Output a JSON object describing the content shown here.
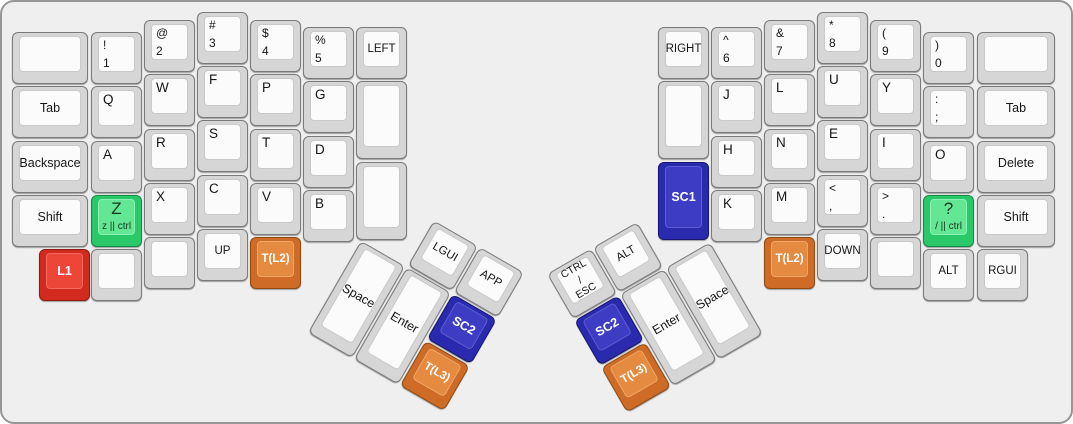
{
  "board": {
    "name": "split-keyboard-layout",
    "background": "#efefef",
    "case_border": "#969696"
  },
  "colors": {
    "default": {
      "side": "#d6d6d6",
      "top": "#fbfbfb",
      "border": "#7a7a7a",
      "topBorder": "#c9c9c9",
      "text": "#161616"
    },
    "red": {
      "side": "#d22a1e",
      "top": "#ee4539",
      "border": "#8f1a12",
      "topBorder": "#f26a60",
      "text": "#ffffff"
    },
    "green": {
      "side": "#29c96a",
      "top": "#63e794",
      "border": "#128a43",
      "topBorder": "#8df0b4",
      "text": "#12351f"
    },
    "blue": {
      "side": "#2a2aae",
      "top": "#3d3dc4",
      "border": "#16166e",
      "topBorder": "#5c5cd4",
      "text": "#ffffff"
    },
    "orange": {
      "side": "#cd6b27",
      "top": "#e58a41",
      "border": "#8f4a12",
      "topBorder": "#efa768",
      "text": "#ffffff"
    }
  },
  "clusters": [
    {
      "name": "left-thumb-cluster",
      "x": 386,
      "y": 192,
      "angle": 30
    },
    {
      "name": "right-thumb-cluster",
      "x": 545,
      "y": 272,
      "angle": -30
    }
  ],
  "keys": [
    {
      "name": "key-blank-left-top",
      "x": 10,
      "y": 30,
      "w": 76
    },
    {
      "name": "key-tab-left",
      "x": 10,
      "y": 84,
      "w": 76,
      "label": {
        "style": "center",
        "lines": [
          "Tab"
        ]
      }
    },
    {
      "name": "key-backspace",
      "x": 10,
      "y": 139,
      "w": 76,
      "label": {
        "style": "center",
        "lines": [
          "Backspace"
        ]
      }
    },
    {
      "name": "key-shift-left",
      "x": 10,
      "y": 193,
      "w": 76,
      "label": {
        "style": "center",
        "lines": [
          "Shift"
        ]
      }
    },
    {
      "name": "key-l1",
      "x": 37,
      "y": 247,
      "color": "red",
      "label": {
        "style": "center",
        "bold": true,
        "lines": [
          "L1"
        ]
      }
    },
    {
      "name": "key-exclam-1",
      "x": 89,
      "y": 30,
      "label": {
        "style": "sym",
        "lines": [
          "!",
          "1"
        ]
      }
    },
    {
      "name": "key-q",
      "x": 89,
      "y": 84,
      "label": {
        "style": "letter",
        "lines": [
          "Q"
        ]
      }
    },
    {
      "name": "key-a",
      "x": 89,
      "y": 139,
      "label": {
        "style": "letter",
        "lines": [
          "A"
        ]
      }
    },
    {
      "name": "key-z-ctrl",
      "x": 89,
      "y": 193,
      "color": "green",
      "label": {
        "style": "combo",
        "lines": [
          "Z",
          "z || ctrl"
        ]
      }
    },
    {
      "name": "key-blank-left-col2-bottom",
      "x": 89,
      "y": 247
    },
    {
      "name": "key-at-2",
      "x": 142,
      "y": 18,
      "label": {
        "style": "sym",
        "lines": [
          "@",
          "2"
        ]
      }
    },
    {
      "name": "key-w",
      "x": 142,
      "y": 72,
      "label": {
        "style": "letter",
        "lines": [
          "W"
        ]
      }
    },
    {
      "name": "key-r",
      "x": 142,
      "y": 127,
      "label": {
        "style": "letter",
        "lines": [
          "R"
        ]
      }
    },
    {
      "name": "key-x",
      "x": 142,
      "y": 181,
      "label": {
        "style": "letter",
        "lines": [
          "X"
        ]
      }
    },
    {
      "name": "key-blank-left-col3-bottom",
      "x": 142,
      "y": 235
    },
    {
      "name": "key-hash-3",
      "x": 195,
      "y": 10,
      "label": {
        "style": "sym",
        "lines": [
          "#",
          "3"
        ]
      }
    },
    {
      "name": "key-f",
      "x": 195,
      "y": 64,
      "label": {
        "style": "letter",
        "lines": [
          "F"
        ]
      }
    },
    {
      "name": "key-s",
      "x": 195,
      "y": 118,
      "label": {
        "style": "letter",
        "lines": [
          "S"
        ]
      }
    },
    {
      "name": "key-c",
      "x": 195,
      "y": 173,
      "label": {
        "style": "letter",
        "lines": [
          "C"
        ]
      }
    },
    {
      "name": "key-up",
      "x": 195,
      "y": 227,
      "label": {
        "style": "center-small",
        "lines": [
          "UP"
        ]
      }
    },
    {
      "name": "key-dollar-4",
      "x": 248,
      "y": 18,
      "label": {
        "style": "sym",
        "lines": [
          "$",
          "4"
        ]
      }
    },
    {
      "name": "key-p",
      "x": 248,
      "y": 72,
      "label": {
        "style": "letter",
        "lines": [
          "P"
        ]
      }
    },
    {
      "name": "key-t",
      "x": 248,
      "y": 127,
      "label": {
        "style": "letter",
        "lines": [
          "T"
        ]
      }
    },
    {
      "name": "key-v",
      "x": 248,
      "y": 181,
      "label": {
        "style": "letter",
        "lines": [
          "V"
        ]
      }
    },
    {
      "name": "key-t-l2-left",
      "x": 248,
      "y": 235,
      "color": "orange",
      "label": {
        "style": "center-small",
        "bold": true,
        "lines": [
          "T(L2)"
        ]
      }
    },
    {
      "name": "key-percent-5",
      "x": 301,
      "y": 25,
      "label": {
        "style": "sym",
        "lines": [
          "%",
          "5"
        ]
      }
    },
    {
      "name": "key-g",
      "x": 301,
      "y": 79,
      "label": {
        "style": "letter",
        "lines": [
          "G"
        ]
      }
    },
    {
      "name": "key-d",
      "x": 301,
      "y": 134,
      "label": {
        "style": "letter",
        "lines": [
          "D"
        ]
      }
    },
    {
      "name": "key-b",
      "x": 301,
      "y": 188,
      "label": {
        "style": "letter",
        "lines": [
          "B"
        ]
      }
    },
    {
      "name": "key-left",
      "x": 354,
      "y": 25,
      "label": {
        "style": "center-small",
        "lines": [
          "LEFT"
        ]
      }
    },
    {
      "name": "key-blank-left-col7-mid",
      "x": 354,
      "y": 79,
      "h": 78
    },
    {
      "name": "key-blank-left-col7-bottom",
      "x": 354,
      "y": 160,
      "h": 78
    },
    {
      "name": "key-space-left",
      "cluster": "left-thumb-cluster",
      "x": 0,
      "y": 54,
      "h": 106,
      "label": {
        "style": "center",
        "lines": [
          "Space"
        ]
      }
    },
    {
      "name": "key-enter-left",
      "cluster": "left-thumb-cluster",
      "x": 53,
      "y": 54,
      "h": 106,
      "label": {
        "style": "center",
        "lines": [
          "Enter"
        ]
      }
    },
    {
      "name": "key-lgui",
      "cluster": "left-thumb-cluster",
      "x": 53,
      "y": 0,
      "label": {
        "style": "center-small",
        "lines": [
          "LGUI"
        ]
      }
    },
    {
      "name": "key-app",
      "cluster": "left-thumb-cluster",
      "x": 106,
      "y": 0,
      "label": {
        "style": "center-small",
        "lines": [
          "APP"
        ]
      }
    },
    {
      "name": "key-sc2-left",
      "cluster": "left-thumb-cluster",
      "x": 106,
      "y": 54,
      "color": "blue",
      "label": {
        "style": "center",
        "bold": true,
        "lines": [
          "SC2"
        ]
      }
    },
    {
      "name": "key-t-l3-left",
      "cluster": "left-thumb-cluster",
      "x": 106,
      "y": 108,
      "color": "orange",
      "label": {
        "style": "center-small",
        "bold": true,
        "lines": [
          "T(L3)"
        ]
      }
    },
    {
      "name": "key-right",
      "x": 656,
      "y": 25,
      "label": {
        "style": "center-small",
        "lines": [
          "RIGHT"
        ]
      }
    },
    {
      "name": "key-blank-right-col1-mid",
      "x": 656,
      "y": 79,
      "h": 78
    },
    {
      "name": "key-sc1",
      "x": 656,
      "y": 160,
      "h": 78,
      "color": "blue",
      "label": {
        "style": "center",
        "bold": true,
        "lines": [
          "SC1"
        ]
      }
    },
    {
      "name": "key-caret-6",
      "x": 709,
      "y": 25,
      "label": {
        "style": "sym",
        "lines": [
          "^",
          "6"
        ]
      }
    },
    {
      "name": "key-j",
      "x": 709,
      "y": 79,
      "label": {
        "style": "letter",
        "lines": [
          "J"
        ]
      }
    },
    {
      "name": "key-h",
      "x": 709,
      "y": 134,
      "label": {
        "style": "letter",
        "lines": [
          "H"
        ]
      }
    },
    {
      "name": "key-k",
      "x": 709,
      "y": 188,
      "label": {
        "style": "letter",
        "lines": [
          "K"
        ]
      }
    },
    {
      "name": "key-amp-7",
      "x": 762,
      "y": 18,
      "label": {
        "style": "sym",
        "lines": [
          "&",
          "7"
        ]
      }
    },
    {
      "name": "key-l",
      "x": 762,
      "y": 72,
      "label": {
        "style": "letter",
        "lines": [
          "L"
        ]
      }
    },
    {
      "name": "key-n",
      "x": 762,
      "y": 127,
      "label": {
        "style": "letter",
        "lines": [
          "N"
        ]
      }
    },
    {
      "name": "key-m",
      "x": 762,
      "y": 181,
      "label": {
        "style": "letter",
        "lines": [
          "M"
        ]
      }
    },
    {
      "name": "key-t-l2-right",
      "x": 762,
      "y": 235,
      "color": "orange",
      "label": {
        "style": "center-small",
        "bold": true,
        "lines": [
          "T(L2)"
        ]
      }
    },
    {
      "name": "key-star-8",
      "x": 815,
      "y": 10,
      "label": {
        "style": "sym",
        "lines": [
          "*",
          "8"
        ]
      }
    },
    {
      "name": "key-u",
      "x": 815,
      "y": 64,
      "label": {
        "style": "letter",
        "lines": [
          "U"
        ]
      }
    },
    {
      "name": "key-e",
      "x": 815,
      "y": 118,
      "label": {
        "style": "letter",
        "lines": [
          "E"
        ]
      }
    },
    {
      "name": "key-less-comma",
      "x": 815,
      "y": 173,
      "label": {
        "style": "sym",
        "lines": [
          "<",
          ","
        ]
      }
    },
    {
      "name": "key-down",
      "x": 815,
      "y": 227,
      "label": {
        "style": "center-small",
        "lines": [
          "DOWN"
        ]
      }
    },
    {
      "name": "key-paren-9",
      "x": 868,
      "y": 18,
      "label": {
        "style": "sym",
        "lines": [
          "(",
          "9"
        ]
      }
    },
    {
      "name": "key-y",
      "x": 868,
      "y": 72,
      "label": {
        "style": "letter",
        "lines": [
          "Y"
        ]
      }
    },
    {
      "name": "key-i",
      "x": 868,
      "y": 127,
      "label": {
        "style": "letter",
        "lines": [
          "I"
        ]
      }
    },
    {
      "name": "key-greater-period",
      "x": 868,
      "y": 181,
      "label": {
        "style": "sym",
        "lines": [
          ">",
          "."
        ]
      }
    },
    {
      "name": "key-blank-right-col5-bottom",
      "x": 868,
      "y": 235
    },
    {
      "name": "key-paren-0",
      "x": 921,
      "y": 30,
      "label": {
        "style": "sym",
        "lines": [
          ")",
          "0"
        ]
      }
    },
    {
      "name": "key-colon-semicolon",
      "x": 921,
      "y": 84,
      "label": {
        "style": "sym",
        "lines": [
          ":",
          ";"
        ]
      }
    },
    {
      "name": "key-o",
      "x": 921,
      "y": 139,
      "label": {
        "style": "letter",
        "lines": [
          "O"
        ]
      }
    },
    {
      "name": "key-question-ctrl",
      "x": 921,
      "y": 193,
      "color": "green",
      "label": {
        "style": "combo",
        "lines": [
          "?",
          "/ || ctrl"
        ]
      }
    },
    {
      "name": "key-alt",
      "x": 921,
      "y": 247,
      "label": {
        "style": "center-small",
        "lines": [
          "ALT"
        ]
      }
    },
    {
      "name": "key-blank-right-top",
      "x": 975,
      "y": 30,
      "w": 78
    },
    {
      "name": "key-tab-right",
      "x": 975,
      "y": 84,
      "w": 78,
      "label": {
        "style": "center",
        "lines": [
          "Tab"
        ]
      }
    },
    {
      "name": "key-delete",
      "x": 975,
      "y": 139,
      "w": 78,
      "label": {
        "style": "center",
        "lines": [
          "Delete"
        ]
      }
    },
    {
      "name": "key-shift-right",
      "x": 975,
      "y": 193,
      "w": 78,
      "label": {
        "style": "center",
        "lines": [
          "Shift"
        ]
      }
    },
    {
      "name": "key-rgui",
      "x": 975,
      "y": 247,
      "label": {
        "style": "center-small",
        "lines": [
          "RGUI"
        ]
      }
    },
    {
      "name": "key-ctrl-esc",
      "cluster": "right-thumb-cluster",
      "x": 0,
      "y": 0,
      "label": {
        "style": "center-xs",
        "lines": [
          "CTRL",
          "/",
          "ESC"
        ]
      }
    },
    {
      "name": "key-alt-thumb",
      "cluster": "right-thumb-cluster",
      "x": 53,
      "y": 0,
      "label": {
        "style": "center-small",
        "lines": [
          "ALT"
        ]
      }
    },
    {
      "name": "key-sc2-right",
      "cluster": "right-thumb-cluster",
      "x": 0,
      "y": 54,
      "color": "blue",
      "label": {
        "style": "center",
        "bold": true,
        "lines": [
          "SC2"
        ]
      }
    },
    {
      "name": "key-t-l3-right",
      "cluster": "right-thumb-cluster",
      "x": 0,
      "y": 108,
      "color": "orange",
      "label": {
        "style": "center-small",
        "bold": true,
        "lines": [
          "T(L3)"
        ]
      }
    },
    {
      "name": "key-enter-right",
      "cluster": "right-thumb-cluster",
      "x": 53,
      "y": 54,
      "h": 106,
      "label": {
        "style": "center",
        "lines": [
          "Enter"
        ]
      }
    },
    {
      "name": "key-space-right",
      "cluster": "right-thumb-cluster",
      "x": 106,
      "y": 54,
      "h": 106,
      "label": {
        "style": "center",
        "lines": [
          "Space"
        ]
      }
    }
  ]
}
